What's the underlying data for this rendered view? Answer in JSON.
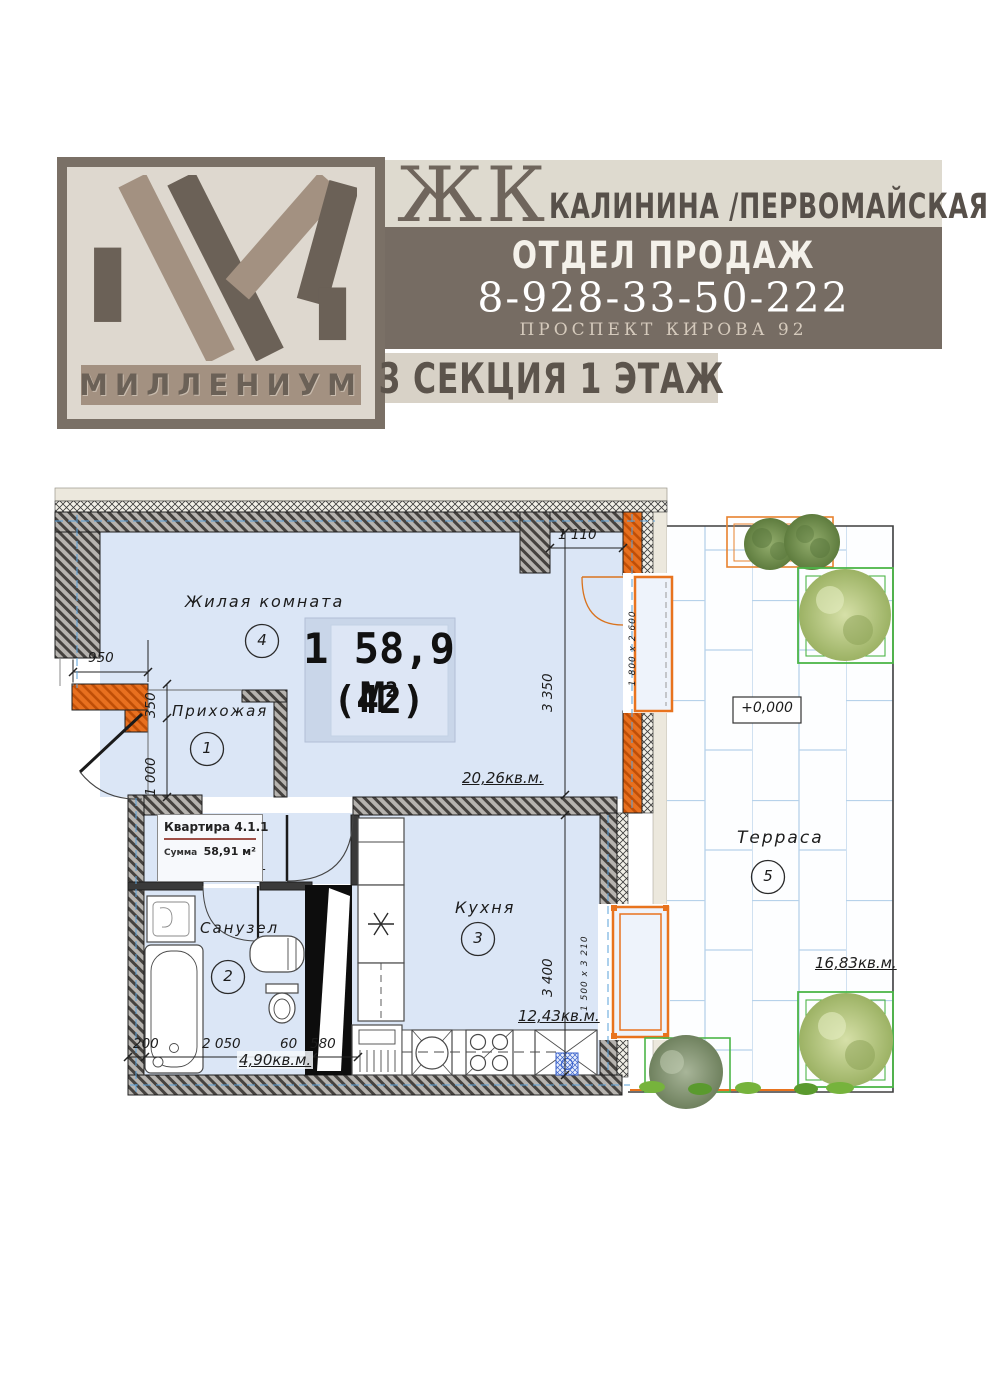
{
  "header": {
    "logo_brand": "МИЛЛЕНИУМ",
    "complex_prefix": "ЖК",
    "complex_name": "КАЛИНИНА /ПЕРВОМАЙСКАЯ",
    "sales": {
      "title": "ОТДЕЛ ПРОДАЖ",
      "phone": "8-928-33-50-222",
      "address": "ПРОСПЕКТ КИРОВА 92"
    },
    "section_label": "3 СЕКЦИЯ 1 ЭТАЖ"
  },
  "plan": {
    "unit": {
      "size_label": "1 58,9 М",
      "sup": "2",
      "number": "(42)"
    },
    "info": {
      "title": "Квартира 4.1.1",
      "sum_label": "Сумма",
      "sum_value": "58,91 м²"
    },
    "level_mark": "+0,000",
    "rooms": [
      {
        "name": "Жилая комната",
        "number": "4",
        "area": "20,26кв.м."
      },
      {
        "name": "Прихожая",
        "number": "1",
        "area": "4,49кв.м."
      },
      {
        "name": "Санузел",
        "number": "2",
        "area": "4,90кв.м."
      },
      {
        "name": "Кухня",
        "number": "3",
        "area": "12,43кв.м."
      },
      {
        "name": "Терраса",
        "number": "5",
        "area": "16,83кв.м."
      }
    ],
    "dims": {
      "w950": "950",
      "w350": "350",
      "w1000": "1 000",
      "w1110": "1 110",
      "h3350": "3 350",
      "h3400": "3 400",
      "b200": "200",
      "b2050": "2 050",
      "b60": "60",
      "b580": "580",
      "door": "1 800 x 2 600",
      "window": "1 500 x 3 210"
    },
    "colors": {
      "brand_dark": "#6b6157",
      "brand_taupe": "#a39181",
      "brand_beige": "#ded8cf",
      "band_dark": "#766c63",
      "wall_orange": "#e8701f",
      "room_fill": "#dbe6f6",
      "tile_line": "#b7d2ea",
      "planting_green": "#4cb648",
      "planting_orange": "#e8822e"
    }
  }
}
